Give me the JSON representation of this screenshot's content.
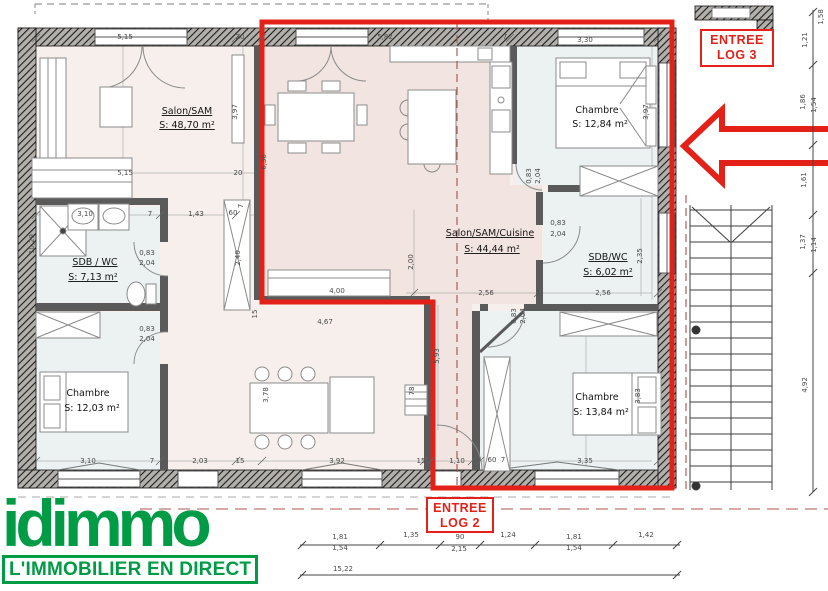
{
  "colors": {
    "red": "#e32119",
    "green": "#009b45",
    "wall": "#5a5a5a",
    "dim_text": "#4a4a4a"
  },
  "branding": {
    "logo": "idimmo",
    "tagline": "L'IMMOBILIER EN DIRECT"
  },
  "entries": {
    "log3": {
      "line1": "ENTREE",
      "line2": "LOG 3"
    },
    "log2": {
      "line1": "ENTREE",
      "line2": "LOG 2"
    }
  },
  "plan": {
    "rooms": [
      {
        "name": "Salon/SAM",
        "area": "S: 48,70 m²",
        "nx": 187,
        "ny": 114,
        "ax": 187,
        "ay": 128,
        "u": true
      },
      {
        "name": "Chambre",
        "area": "S: 12,84 m²",
        "nx": 597,
        "ny": 113,
        "ax": 600,
        "ay": 127,
        "u": false
      },
      {
        "name": "SDB / WC",
        "area": "S: 7,13 m²",
        "nx": 95,
        "ny": 265,
        "ax": 93,
        "ay": 280,
        "u": true
      },
      {
        "name": "Salon/SAM/Cuisine",
        "area": "S:      44,44 m²",
        "nx": 490,
        "ny": 236,
        "ax": 492,
        "ay": 252,
        "u": true
      },
      {
        "name": "SDB/WC",
        "area": "S: 6,02 m²",
        "nx": 608,
        "ny": 260,
        "ax": 608,
        "ay": 275,
        "u": true
      },
      {
        "name": "Chambre",
        "area": "S: 12,03 m²",
        "nx": 88,
        "ny": 396,
        "ax": 92,
        "ay": 411,
        "u": false
      },
      {
        "name": "Chambre",
        "area": "S: 13,84 m²",
        "nx": 597,
        "ny": 400,
        "ax": 601,
        "ay": 415,
        "u": false
      }
    ],
    "dimensions": [
      {
        "t": "5,15",
        "x": 125,
        "y": 39
      },
      {
        "t": "20",
        "x": 240,
        "y": 39
      },
      {
        "t": "5,82",
        "x": 385,
        "y": 39
      },
      {
        "t": "7",
        "x": 505,
        "y": 39
      },
      {
        "t": "3,30",
        "x": 585,
        "y": 42
      },
      {
        "t": "5,15",
        "x": 125,
        "y": 175
      },
      {
        "t": "20",
        "x": 238,
        "y": 175
      },
      {
        "t": "3,97",
        "x": 237,
        "y": 112,
        "r": -90
      },
      {
        "t": "3,97",
        "x": 648,
        "y": 112,
        "r": -90
      },
      {
        "t": "6,36",
        "x": 266,
        "y": 162,
        "r": -90
      },
      {
        "t": "10,29",
        "x": 34,
        "y": 244,
        "r": -90
      },
      {
        "t": "2,40",
        "x": 240,
        "y": 258,
        "r": -90
      },
      {
        "t": "2,00",
        "x": 413,
        "y": 262,
        "r": -90
      },
      {
        "t": "2,35",
        "x": 642,
        "y": 256,
        "r": -90
      },
      {
        "t": "5,93",
        "x": 439,
        "y": 356,
        "r": -90
      },
      {
        "t": "3,78",
        "x": 268,
        "y": 395,
        "r": -90
      },
      {
        "t": "3,83",
        "x": 640,
        "y": 396,
        "r": -90
      },
      {
        "t": "78",
        "x": 414,
        "y": 391,
        "r": -90
      },
      {
        "t": "15",
        "x": 257,
        "y": 314,
        "r": -90
      },
      {
        "t": "3,10",
        "x": 85,
        "y": 216
      },
      {
        "t": "7",
        "x": 150,
        "y": 216
      },
      {
        "t": "1,43",
        "x": 196,
        "y": 216
      },
      {
        "t": "60",
        "x": 233,
        "y": 215
      },
      {
        "t": "7",
        "x": 243,
        "y": 206,
        "r": -90
      },
      {
        "t": "0,83",
        "x": 147,
        "y": 255
      },
      {
        "t": "2,04",
        "x": 147,
        "y": 265
      },
      {
        "t": "0,83",
        "x": 147,
        "y": 331
      },
      {
        "t": "2,04",
        "x": 147,
        "y": 341
      },
      {
        "t": "0,83",
        "x": 558,
        "y": 225
      },
      {
        "t": "2,04",
        "x": 558,
        "y": 236
      },
      {
        "t": "0,83",
        "x": 516,
        "y": 316,
        "r": -90
      },
      {
        "t": "2,04",
        "x": 525,
        "y": 316,
        "r": -90
      },
      {
        "t": "0,83",
        "x": 531,
        "y": 176,
        "r": -90
      },
      {
        "t": "2,04",
        "x": 540,
        "y": 176,
        "r": -90
      },
      {
        "t": "2,56",
        "x": 486,
        "y": 295
      },
      {
        "t": "7",
        "x": 538,
        "y": 295
      },
      {
        "t": "2,56",
        "x": 603,
        "y": 295
      },
      {
        "t": "4,00",
        "x": 337,
        "y": 293
      },
      {
        "t": "4,67",
        "x": 325,
        "y": 324
      },
      {
        "t": "3,10",
        "x": 88,
        "y": 463
      },
      {
        "t": "7",
        "x": 152,
        "y": 463
      },
      {
        "t": "2,03",
        "x": 200,
        "y": 463
      },
      {
        "t": "15",
        "x": 240,
        "y": 463
      },
      {
        "t": "3,92",
        "x": 337,
        "y": 463
      },
      {
        "t": "15",
        "x": 421,
        "y": 463
      },
      {
        "t": "1,10",
        "x": 457,
        "y": 463
      },
      {
        "t": "60",
        "x": 492,
        "y": 462
      },
      {
        "t": "7",
        "x": 503,
        "y": 462
      },
      {
        "t": "3,35",
        "x": 585,
        "y": 463
      },
      {
        "t": "1,58",
        "x": 823,
        "y": 17,
        "r": -90
      },
      {
        "t": "1,21",
        "x": 807,
        "y": 40,
        "r": -90
      },
      {
        "t": "1,86",
        "x": 805,
        "y": 102,
        "r": -90
      },
      {
        "t": "1,54",
        "x": 816,
        "y": 105,
        "r": -90
      },
      {
        "t": "1,61",
        "x": 806,
        "y": 180,
        "r": -90
      },
      {
        "t": "1,37",
        "x": 805,
        "y": 242,
        "r": -90
      },
      {
        "t": "1,14",
        "x": 816,
        "y": 245,
        "r": -90
      },
      {
        "t": "4,92",
        "x": 807,
        "y": 385,
        "r": -90
      },
      {
        "t": "1,81",
        "x": 340,
        "y": 539
      },
      {
        "t": "1,54",
        "x": 340,
        "y": 550
      },
      {
        "t": "1,35",
        "x": 411,
        "y": 537
      },
      {
        "t": "90",
        "x": 460,
        "y": 539
      },
      {
        "t": "2,15",
        "x": 459,
        "y": 551
      },
      {
        "t": "1,24",
        "x": 508,
        "y": 537
      },
      {
        "t": "1,81",
        "x": 574,
        "y": 539
      },
      {
        "t": "1,54",
        "x": 574,
        "y": 550
      },
      {
        "t": "1,42",
        "x": 646,
        "y": 537
      },
      {
        "t": "15,22",
        "x": 343,
        "y": 571
      }
    ]
  }
}
